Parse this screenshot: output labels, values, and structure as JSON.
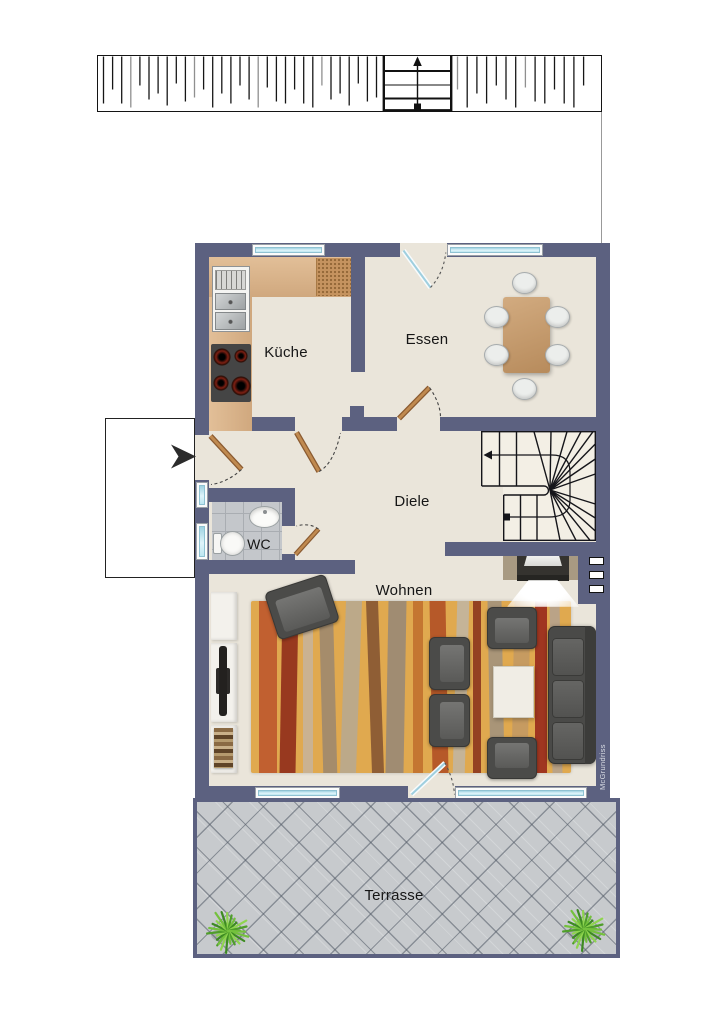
{
  "plan": {
    "watermark": "McGrundriss",
    "rooms": {
      "kueche": {
        "label": "Küche"
      },
      "essen": {
        "label": "Essen"
      },
      "diele": {
        "label": "Diele"
      },
      "wc": {
        "label": "WC"
      },
      "wohnen": {
        "label": "Wohnen"
      },
      "terrasse": {
        "label": "Terrasse"
      }
    },
    "colors": {
      "wall": "#5c6180",
      "floor": "#eae5da",
      "stair_floor": "#f3efe5",
      "window_glass": "#cdeef6",
      "kitchen_counter": "#d8b68e",
      "cutting_board": "#c5935f",
      "dining_table": "#c49b6d",
      "rug": "#e0a94f",
      "seating": "#4b4b49",
      "coffee_table": "#f0ede5",
      "wc_tile": "#c4c7cb",
      "terrace_tile": "#c7cacd",
      "door_leaf": "#bf8a52",
      "plant_green": "#5fae31",
      "outline": "#1a1a1a"
    }
  }
}
